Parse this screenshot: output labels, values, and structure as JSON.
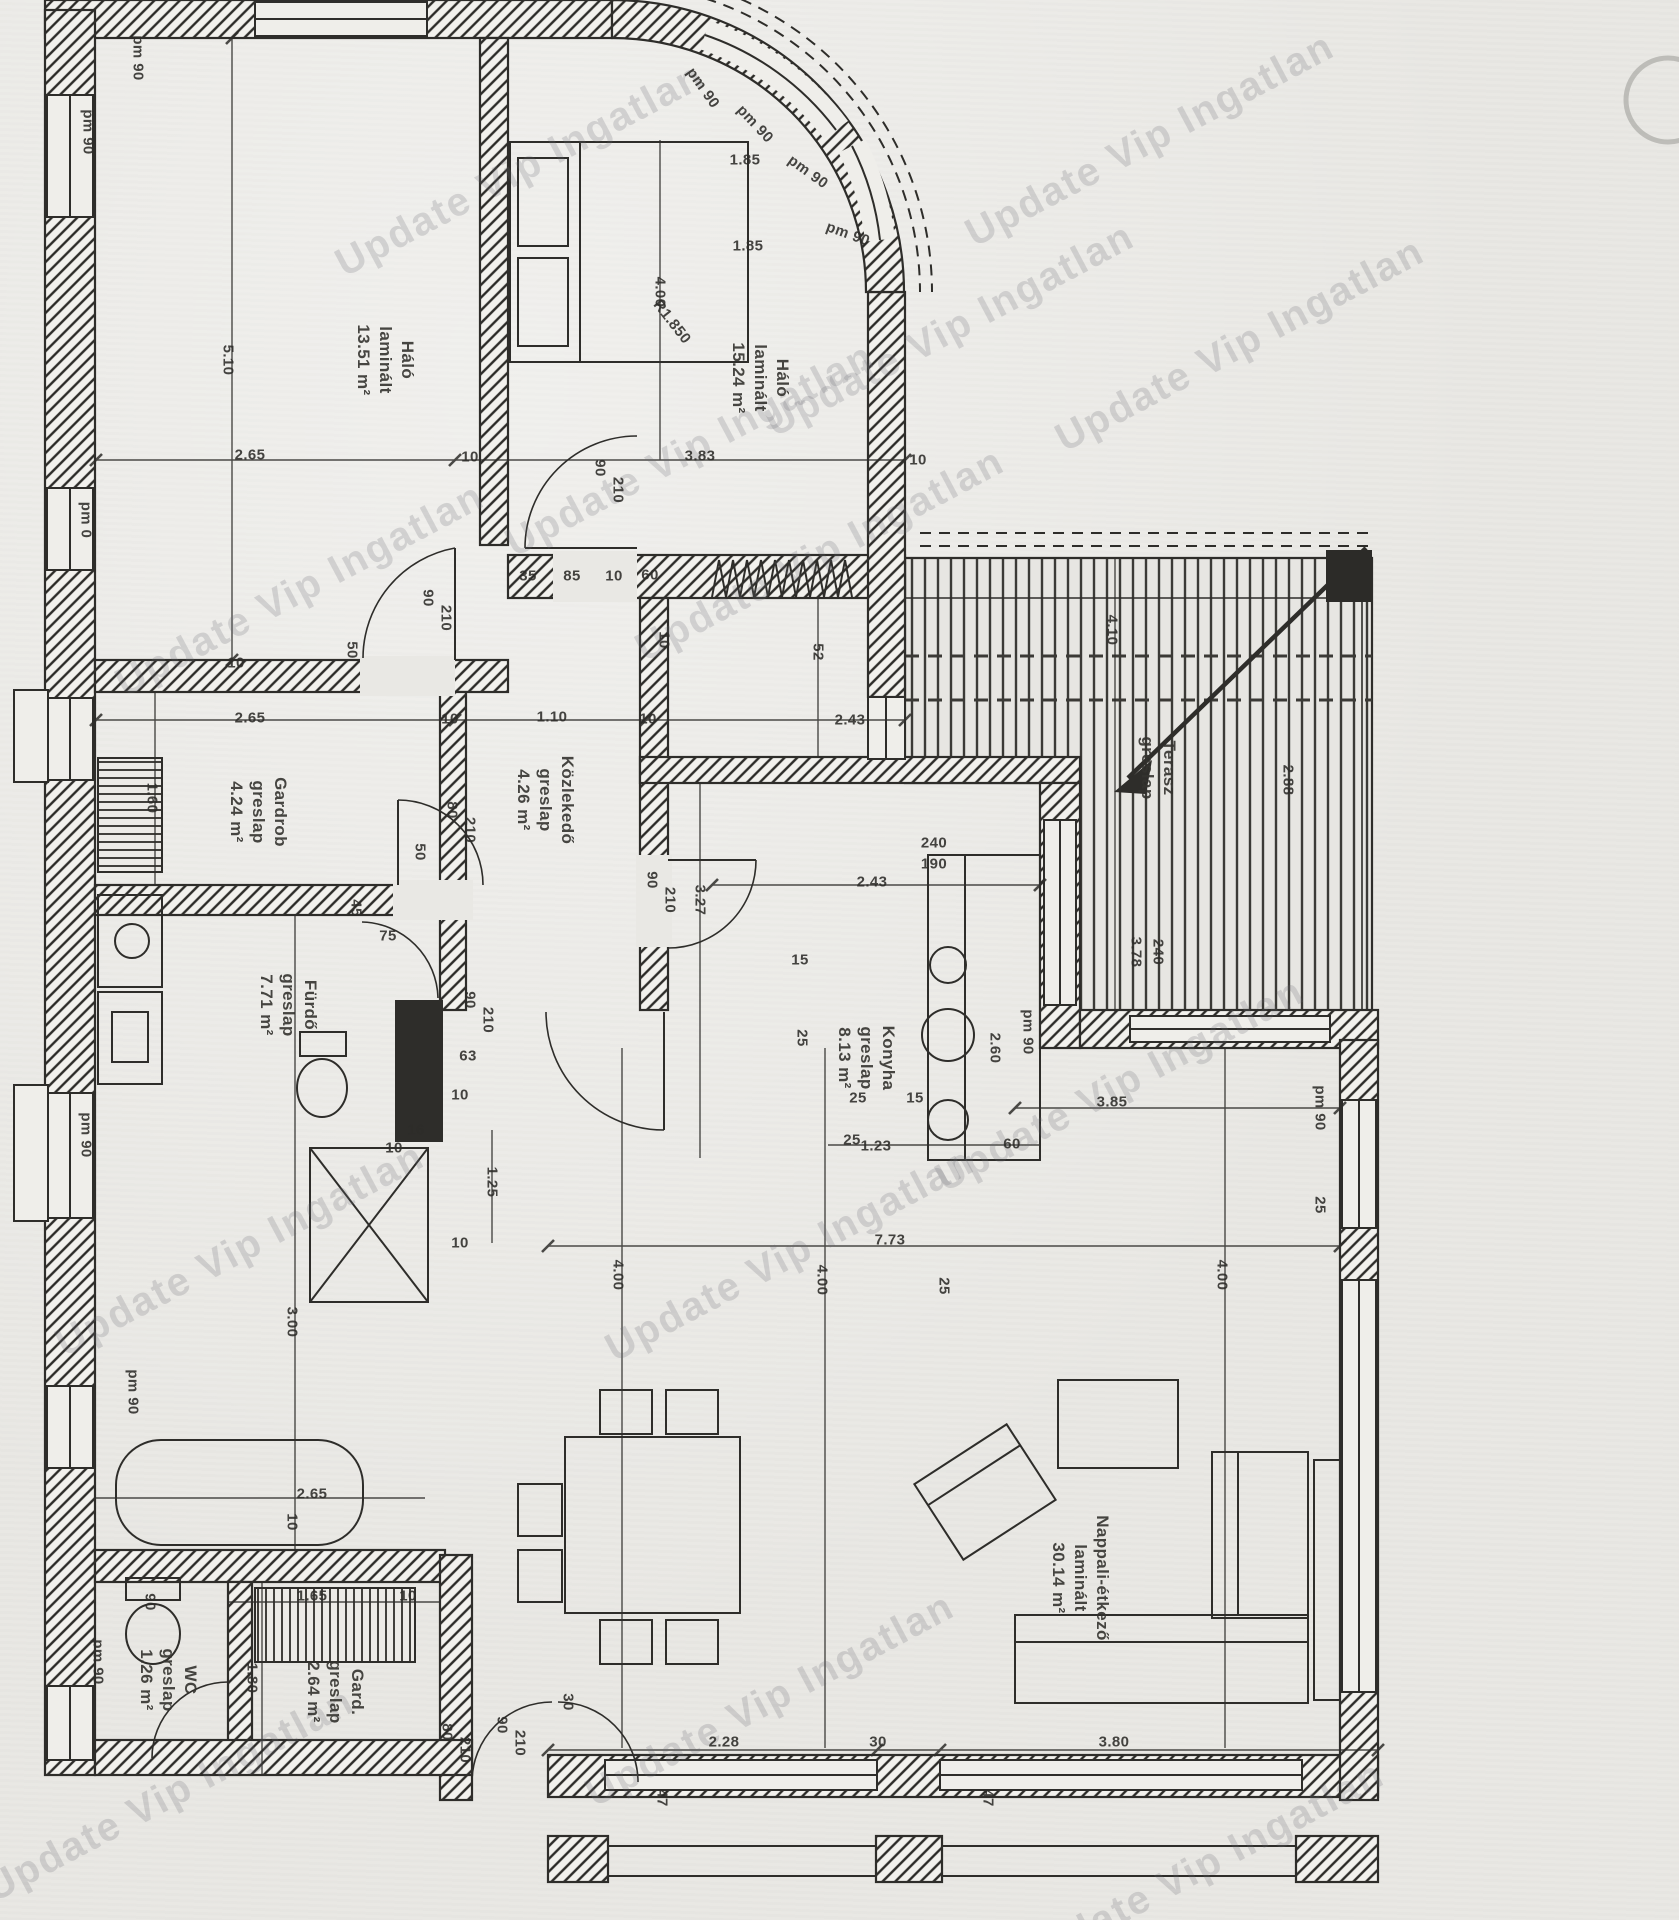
{
  "colors": {
    "paper": "#e9e8e4",
    "ink": "#2e2d2a",
    "hatch_bg": "#f2f1ed",
    "watermark": "rgba(105,105,112,0.22)"
  },
  "watermark": {
    "text": "Update Vip Ingatlan",
    "instances": [
      {
        "x": 520,
        "y": 170
      },
      {
        "x": 300,
        "y": 590
      },
      {
        "x": 690,
        "y": 450
      },
      {
        "x": 1150,
        "y": 140
      },
      {
        "x": 1240,
        "y": 345
      },
      {
        "x": 820,
        "y": 555
      },
      {
        "x": 1120,
        "y": 1085
      },
      {
        "x": 790,
        "y": 1255
      },
      {
        "x": 240,
        "y": 1250
      },
      {
        "x": 770,
        "y": 1700
      },
      {
        "x": 1200,
        "y": 1868
      },
      {
        "x": 170,
        "y": 1795
      },
      {
        "x": 950,
        "y": 330
      }
    ]
  },
  "rooms": [
    {
      "name": "Háló",
      "flooring": "laminált",
      "area": "13.51 m²",
      "x": 385,
      "y": 360
    },
    {
      "name": "Háló",
      "flooring": "laminált",
      "area": "15.24 m²",
      "x": 760,
      "y": 378
    },
    {
      "name": "Gardrob",
      "flooring": "greslap",
      "area": "4.24 m²",
      "x": 258,
      "y": 812
    },
    {
      "name": "Közlekedő",
      "flooring": "greslap",
      "area": "4.26 m²",
      "x": 545,
      "y": 800
    },
    {
      "name": "Fürdő",
      "flooring": "greslap",
      "area": "7.71 m²",
      "x": 288,
      "y": 1005
    },
    {
      "name": "Konyha",
      "flooring": "greslap",
      "area": "8.13 m²",
      "x": 866,
      "y": 1058
    },
    {
      "name": "WC",
      "flooring": "greslap",
      "area": "1.26 m²",
      "x": 168,
      "y": 1680
    },
    {
      "name": "Gard.",
      "flooring": "greslap",
      "area": "2.64 m²",
      "x": 335,
      "y": 1692
    },
    {
      "name": "Nappali-étkező",
      "flooring": "laminált",
      "area": "30.14 m²",
      "x": 1080,
      "y": 1578
    },
    {
      "name": "Terasz",
      "flooring": "greslap",
      "area": "",
      "x": 1158,
      "y": 768
    }
  ],
  "annotations": [
    {
      "text": "pm 90",
      "x": 138,
      "y": 58,
      "rot": 90
    },
    {
      "text": "pm 90",
      "x": 88,
      "y": 132,
      "rot": 90
    },
    {
      "text": "pm 0",
      "x": 86,
      "y": 520,
      "rot": 90
    },
    {
      "text": "pm 90",
      "x": 86,
      "y": 1135,
      "rot": 90
    },
    {
      "text": "pm 90",
      "x": 133,
      "y": 1392,
      "rot": 90
    },
    {
      "text": "pm 90",
      "x": 98,
      "y": 1662,
      "rot": 90
    },
    {
      "text": "pm 90",
      "x": 703,
      "y": 88,
      "rot": 55
    },
    {
      "text": "pm 90",
      "x": 755,
      "y": 124,
      "rot": 47
    },
    {
      "text": "pm 90",
      "x": 808,
      "y": 172,
      "rot": 36
    },
    {
      "text": "pm 90",
      "x": 848,
      "y": 234,
      "rot": 20
    },
    {
      "text": "pm 90",
      "x": 1028,
      "y": 1032,
      "rot": 90
    },
    {
      "text": "pm 90",
      "x": 1320,
      "y": 1108,
      "rot": 90
    },
    {
      "text": "5.10",
      "x": 228,
      "y": 360,
      "rot": 90
    },
    {
      "text": "2.65",
      "x": 250,
      "y": 455,
      "rot": 0
    },
    {
      "text": "10",
      "x": 470,
      "y": 457,
      "rot": 0
    },
    {
      "text": "3.83",
      "x": 700,
      "y": 456,
      "rot": 0
    },
    {
      "text": "10",
      "x": 918,
      "y": 460,
      "rot": 0
    },
    {
      "text": "1.85",
      "x": 745,
      "y": 160,
      "rot": 0
    },
    {
      "text": "1.85",
      "x": 748,
      "y": 246,
      "rot": 0
    },
    {
      "text": "4.00",
      "x": 660,
      "y": 292,
      "rot": 90
    },
    {
      "text": "R1.850",
      "x": 672,
      "y": 322,
      "rot": 52
    },
    {
      "text": "90",
      "x": 600,
      "y": 468,
      "rot": 90
    },
    {
      "text": "210",
      "x": 618,
      "y": 490,
      "rot": 90
    },
    {
      "text": "90",
      "x": 428,
      "y": 598,
      "rot": 90
    },
    {
      "text": "210",
      "x": 446,
      "y": 618,
      "rot": 90
    },
    {
      "text": "50",
      "x": 352,
      "y": 650,
      "rot": 90
    },
    {
      "text": "35",
      "x": 528,
      "y": 576,
      "rot": 0
    },
    {
      "text": "85",
      "x": 572,
      "y": 576,
      "rot": 0
    },
    {
      "text": "10",
      "x": 614,
      "y": 576,
      "rot": 0
    },
    {
      "text": "60",
      "x": 650,
      "y": 575,
      "rot": 0
    },
    {
      "text": "10",
      "x": 664,
      "y": 640,
      "rot": 90
    },
    {
      "text": "52",
      "x": 818,
      "y": 652,
      "rot": 90
    },
    {
      "text": "10",
      "x": 236,
      "y": 663,
      "rot": 0
    },
    {
      "text": "2.65",
      "x": 250,
      "y": 718,
      "rot": 0
    },
    {
      "text": "10",
      "x": 450,
      "y": 719,
      "rot": 0
    },
    {
      "text": "1.10",
      "x": 552,
      "y": 717,
      "rot": 0
    },
    {
      "text": "10",
      "x": 648,
      "y": 719,
      "rot": 0
    },
    {
      "text": "2.43",
      "x": 850,
      "y": 720,
      "rot": 0
    },
    {
      "text": "1.60",
      "x": 152,
      "y": 798,
      "rot": 90
    },
    {
      "text": "80",
      "x": 452,
      "y": 810,
      "rot": 90
    },
    {
      "text": "210",
      "x": 470,
      "y": 830,
      "rot": 90
    },
    {
      "text": "50",
      "x": 420,
      "y": 852,
      "rot": 90
    },
    {
      "text": "3.27",
      "x": 700,
      "y": 900,
      "rot": 90
    },
    {
      "text": "2.43",
      "x": 872,
      "y": 882,
      "rot": 0
    },
    {
      "text": "2.60",
      "x": 995,
      "y": 1048,
      "rot": 90
    },
    {
      "text": "60",
      "x": 1012,
      "y": 1144,
      "rot": 0
    },
    {
      "text": "1.23",
      "x": 876,
      "y": 1146,
      "rot": 0
    },
    {
      "text": "15",
      "x": 800,
      "y": 960,
      "rot": 0
    },
    {
      "text": "25",
      "x": 802,
      "y": 1038,
      "rot": 90
    },
    {
      "text": "90",
      "x": 652,
      "y": 880,
      "rot": 90
    },
    {
      "text": "210",
      "x": 670,
      "y": 900,
      "rot": 90
    },
    {
      "text": "90",
      "x": 470,
      "y": 1000,
      "rot": 90
    },
    {
      "text": "210",
      "x": 488,
      "y": 1020,
      "rot": 90
    },
    {
      "text": "63",
      "x": 468,
      "y": 1056,
      "rot": 0
    },
    {
      "text": "75",
      "x": 388,
      "y": 936,
      "rot": 0
    },
    {
      "text": "45",
      "x": 356,
      "y": 908,
      "rot": 90
    },
    {
      "text": "10",
      "x": 460,
      "y": 1095,
      "rot": 0
    },
    {
      "text": "1.25",
      "x": 492,
      "y": 1182,
      "rot": 90
    },
    {
      "text": "10",
      "x": 460,
      "y": 1243,
      "rot": 0
    },
    {
      "text": "16",
      "x": 416,
      "y": 1130,
      "rot": 0
    },
    {
      "text": "10",
      "x": 394,
      "y": 1148,
      "rot": 0
    },
    {
      "text": "3.00",
      "x": 292,
      "y": 1322,
      "rot": 90
    },
    {
      "text": "2.65",
      "x": 312,
      "y": 1494,
      "rot": 0
    },
    {
      "text": "10",
      "x": 292,
      "y": 1522,
      "rot": 90
    },
    {
      "text": "1.65",
      "x": 312,
      "y": 1596,
      "rot": 0
    },
    {
      "text": "10",
      "x": 408,
      "y": 1596,
      "rot": 0
    },
    {
      "text": "1.80",
      "x": 252,
      "y": 1678,
      "rot": 90
    },
    {
      "text": "90",
      "x": 150,
      "y": 1602,
      "rot": 90
    },
    {
      "text": "30",
      "x": 568,
      "y": 1702,
      "rot": 90
    },
    {
      "text": "80",
      "x": 447,
      "y": 1732,
      "rot": 90
    },
    {
      "text": "210",
      "x": 465,
      "y": 1750,
      "rot": 90
    },
    {
      "text": "90",
      "x": 502,
      "y": 1725,
      "rot": 90
    },
    {
      "text": "210",
      "x": 520,
      "y": 1743,
      "rot": 90
    },
    {
      "text": "25",
      "x": 858,
      "y": 1098,
      "rot": 0
    },
    {
      "text": "15",
      "x": 915,
      "y": 1098,
      "rot": 0
    },
    {
      "text": "25",
      "x": 852,
      "y": 1140,
      "rot": 0
    },
    {
      "text": "25",
      "x": 944,
      "y": 1286,
      "rot": 90
    },
    {
      "text": "3.85",
      "x": 1112,
      "y": 1102,
      "rot": 0
    },
    {
      "text": "7.73",
      "x": 890,
      "y": 1240,
      "rot": 0
    },
    {
      "text": "4.00",
      "x": 618,
      "y": 1275,
      "rot": 90
    },
    {
      "text": "4.00",
      "x": 822,
      "y": 1280,
      "rot": 90
    },
    {
      "text": "4.00",
      "x": 1222,
      "y": 1275,
      "rot": 90
    },
    {
      "text": "25",
      "x": 1320,
      "y": 1205,
      "rot": 90
    },
    {
      "text": "2.28",
      "x": 724,
      "y": 1742,
      "rot": 0
    },
    {
      "text": "30",
      "x": 878,
      "y": 1742,
      "rot": 0
    },
    {
      "text": "3.80",
      "x": 1114,
      "y": 1742,
      "rot": 0
    },
    {
      "text": "47",
      "x": 662,
      "y": 1798,
      "rot": 90
    },
    {
      "text": "47",
      "x": 988,
      "y": 1798,
      "rot": 90
    },
    {
      "text": "4.10",
      "x": 1112,
      "y": 630,
      "rot": 90
    },
    {
      "text": "240",
      "x": 934,
      "y": 843,
      "rot": 0
    },
    {
      "text": "190",
      "x": 934,
      "y": 864,
      "rot": 0
    },
    {
      "text": "3.78",
      "x": 1136,
      "y": 952,
      "rot": 90
    },
    {
      "text": "240",
      "x": 1158,
      "y": 952,
      "rot": 90
    },
    {
      "text": "2.88",
      "x": 1288,
      "y": 780,
      "rot": 90
    }
  ]
}
